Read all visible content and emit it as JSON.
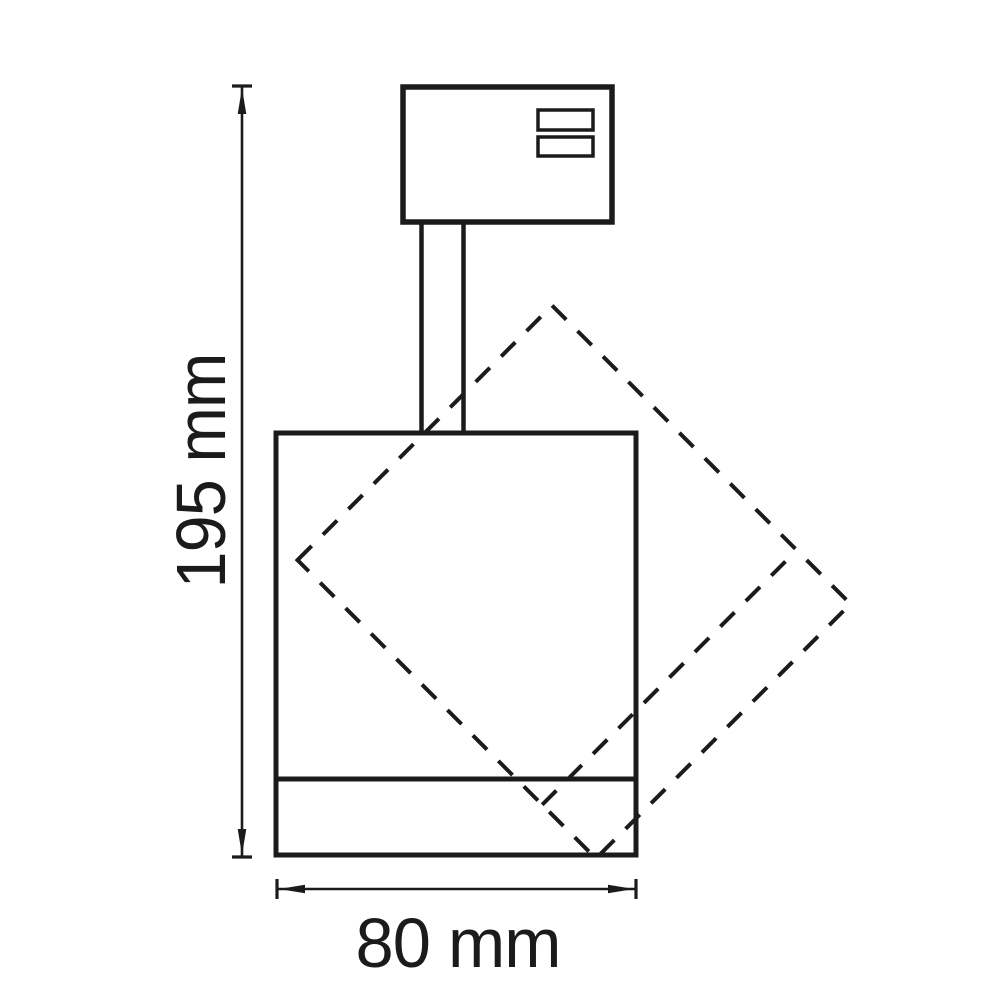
{
  "diagram": {
    "background_color": "#ffffff",
    "line_color": "#1b1b1b",
    "dim_line_color": "#1b1b1b",
    "labels": {
      "height": "195 mm",
      "width": "80 mm"
    }
  }
}
